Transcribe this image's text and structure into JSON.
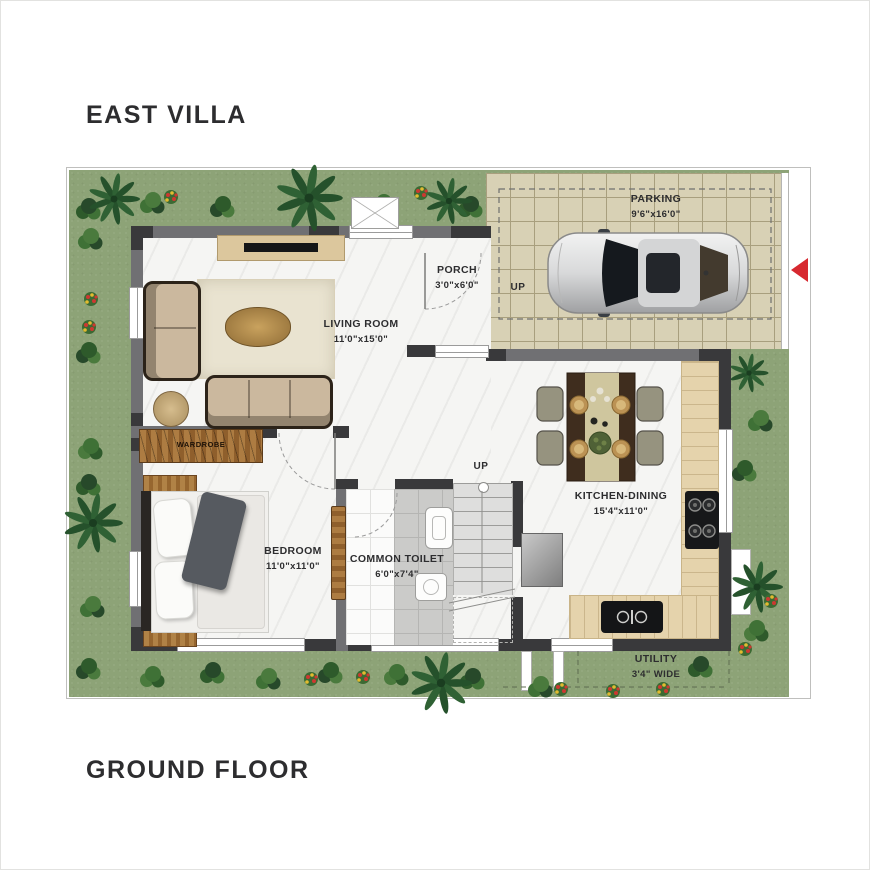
{
  "titles": {
    "villa": "EAST VILLA",
    "floor": "GROUND FLOOR"
  },
  "rooms": {
    "parking": {
      "name": "PARKING",
      "dims": "9'6\"x16'0\""
    },
    "porch": {
      "name": "PORCH",
      "dims": "3'0\"x6'0\""
    },
    "living": {
      "name": "LIVING ROOM",
      "dims": "11'0\"x15'0\""
    },
    "bedroom": {
      "name": "BEDROOM",
      "dims": "11'0\"x11'0\""
    },
    "toilet": {
      "name": "COMMON TOILET",
      "dims": "6'0\"x7'4\""
    },
    "kitchen": {
      "name": "KITCHEN-DINING",
      "dims": "15'4\"x11'0\""
    },
    "utility": {
      "name": "UTILITY",
      "dims": "3'4\" WIDE"
    }
  },
  "labels": {
    "wardrobe": "WARDROBE",
    "up_porch": "UP",
    "up_stairs": "UP"
  },
  "icons": {
    "entry_arrow": "red triangle pointing left at compound entry"
  },
  "colors": {
    "yard": "#8da377",
    "parking_tile": "#d8d1b5",
    "parking_grid": "#a89f7e",
    "wall_dark": "#39393b",
    "wall_mid": "#707073",
    "marble": "#f5f5f3",
    "wood": "#a0713c",
    "rug": "#e9e3d0",
    "sofa": "#cbb89e",
    "sofa_frame": "#2c2319",
    "counter": "#e5d3ac",
    "accent_red": "#d7282f",
    "text": "#2d2d2f"
  }
}
